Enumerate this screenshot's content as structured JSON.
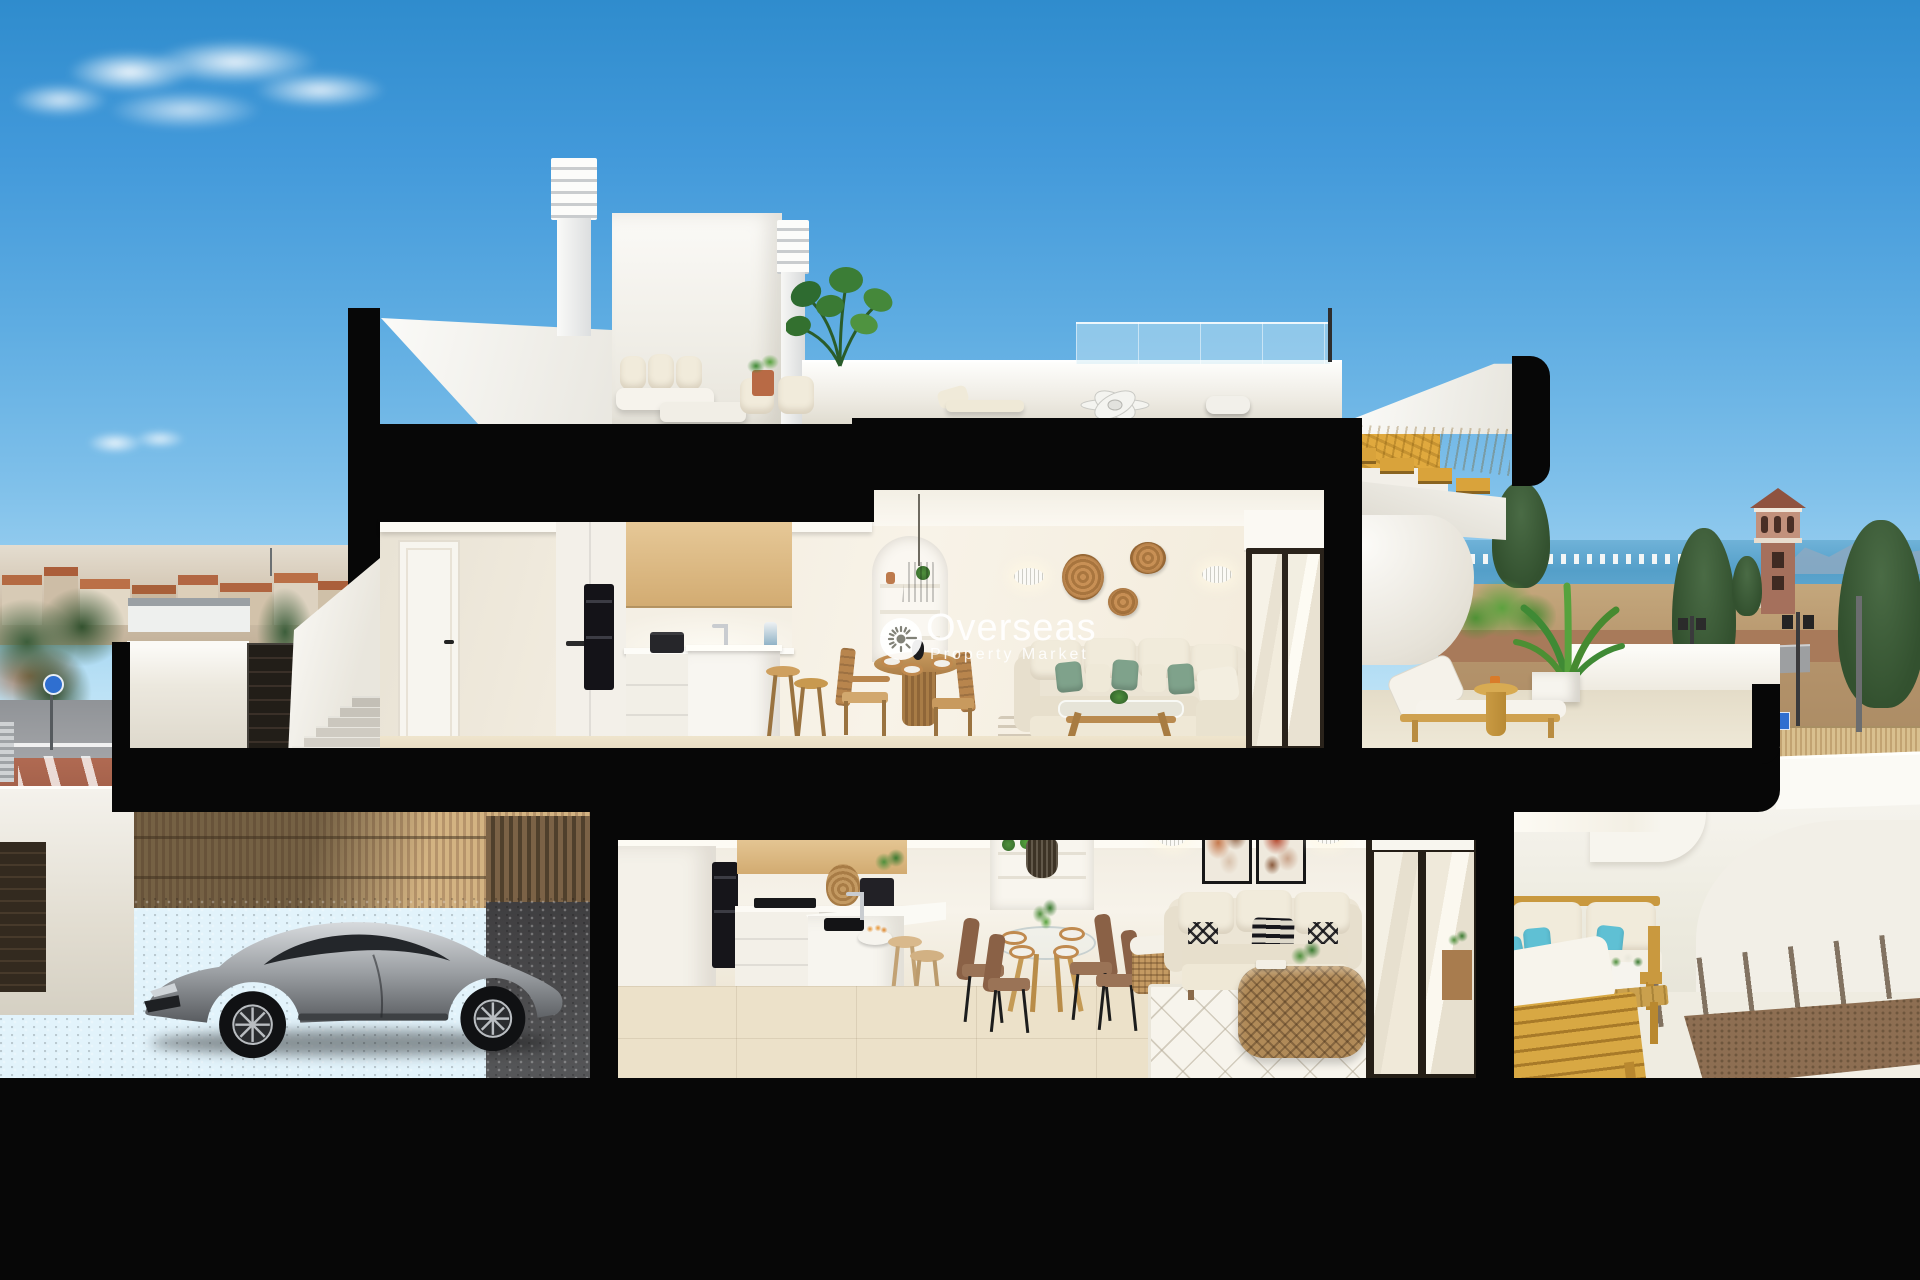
{
  "scene": {
    "type": "3d-cutaway-render",
    "setting": "coastal town, daytime",
    "description": "Cross-section render of a two-storey townhouse: roof terrace with louvred chimneys and lounge set, upper floor with oak kitchen, dining nook, cream living room and terrace with sun lounger and palm, lower floor with carport holding a silver sports coupe, second kitchen, glass dining set, loveseat living room and wooden-furnished terrace; town skyline, sea and a watchtower in the background"
  },
  "watermark": {
    "title": "Overseas",
    "subtitle": "Property Market",
    "icon": "sun-icon",
    "color": "#ffffff"
  },
  "palette": {
    "sky_top": "#3e97d9",
    "sky_horizon": "#cfeaf7",
    "cut_plane": "#070707",
    "interior_wall": "#f3eee4",
    "cabinet_wood": "#dcbc8b",
    "stair_wood": "#d5a23d",
    "floor_beige": "#eae0ca",
    "sofa_cream": "#ebe4d3",
    "pillow_green": "#7fa28b",
    "pillow_teal": "#62c2d6",
    "car_silver": "#a7abaf",
    "bamboo_fence": "#c9a878",
    "sea_blue": "#549fc9",
    "terracotta_roof": "#bd7048",
    "tree_green": "#3c5e3b"
  }
}
